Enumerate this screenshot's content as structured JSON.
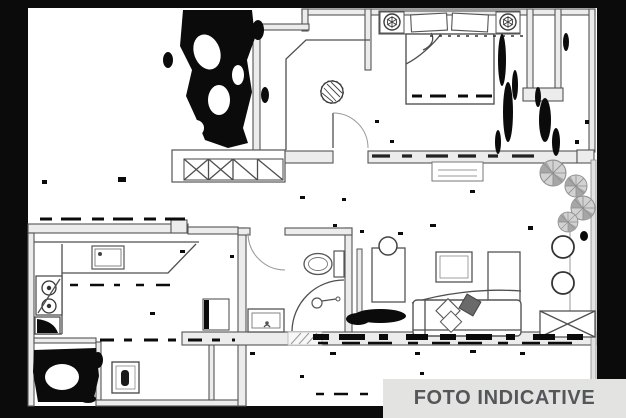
{
  "banner": {
    "label": "FOTO INDICATIVE",
    "bg": "#e3e3e2",
    "text_color": "#55565a"
  },
  "plan": {
    "type": "apartment-floor-plan-scan",
    "rooms": [
      "bedroom",
      "hallway",
      "bathroom",
      "kitchen",
      "living-room",
      "laundry",
      "balcony"
    ],
    "symbols": [
      "double-bed",
      "pillows",
      "nightstand-lamp",
      "plant",
      "window-railing",
      "door-arc",
      "toilet",
      "shower",
      "washbasin",
      "kitchen-sink",
      "stove-burners",
      "corner-cabinet",
      "washing-machine",
      "sofa-with-cushions",
      "coffee-table",
      "tv-cabinet",
      "dining-table",
      "chair-circles",
      "balcony-plants",
      "crossed-window"
    ],
    "colors": {
      "ink": "#0b0b0b",
      "line": "#4f4f4f",
      "line_light": "#9a9a9a",
      "wall_fill": "#ececec",
      "plant_fill": "#d2d2d2"
    }
  }
}
